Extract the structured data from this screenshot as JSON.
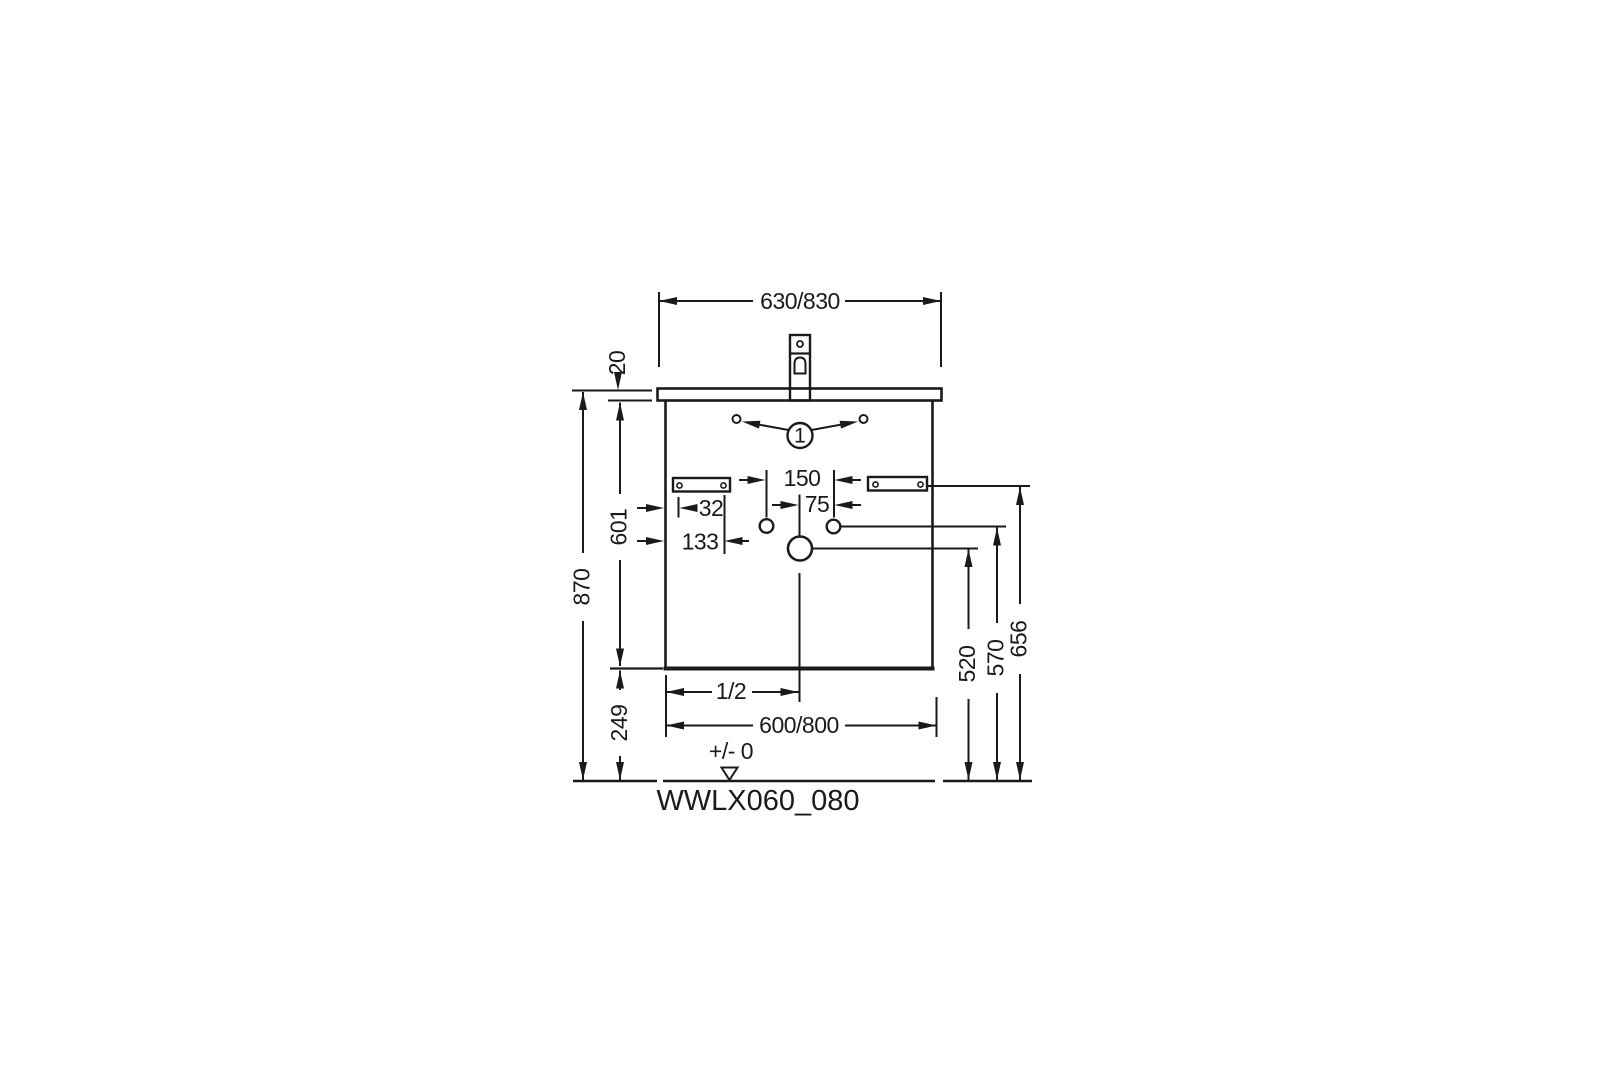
{
  "drawing": {
    "model_code": "WWLX060_080",
    "callout": {
      "number": "1"
    },
    "datum": {
      "label": "+/- 0"
    },
    "dimensions": {
      "top_width": "630/830",
      "countertop_thickness": "20",
      "total_height": "870",
      "cabinet_height": "601",
      "bottom_clearance": "249",
      "tap_hole_spacing": "150",
      "hole_offset": "75",
      "bracket_screw_near": "32",
      "bracket_screw_far": "133",
      "drain_height": "520",
      "side_hole_height": "570",
      "bracket_height": "656",
      "half_width": "1/2",
      "cabinet_width": "600/800"
    },
    "colors": {
      "line": "#1a1a1a",
      "background": "#ffffff"
    }
  }
}
